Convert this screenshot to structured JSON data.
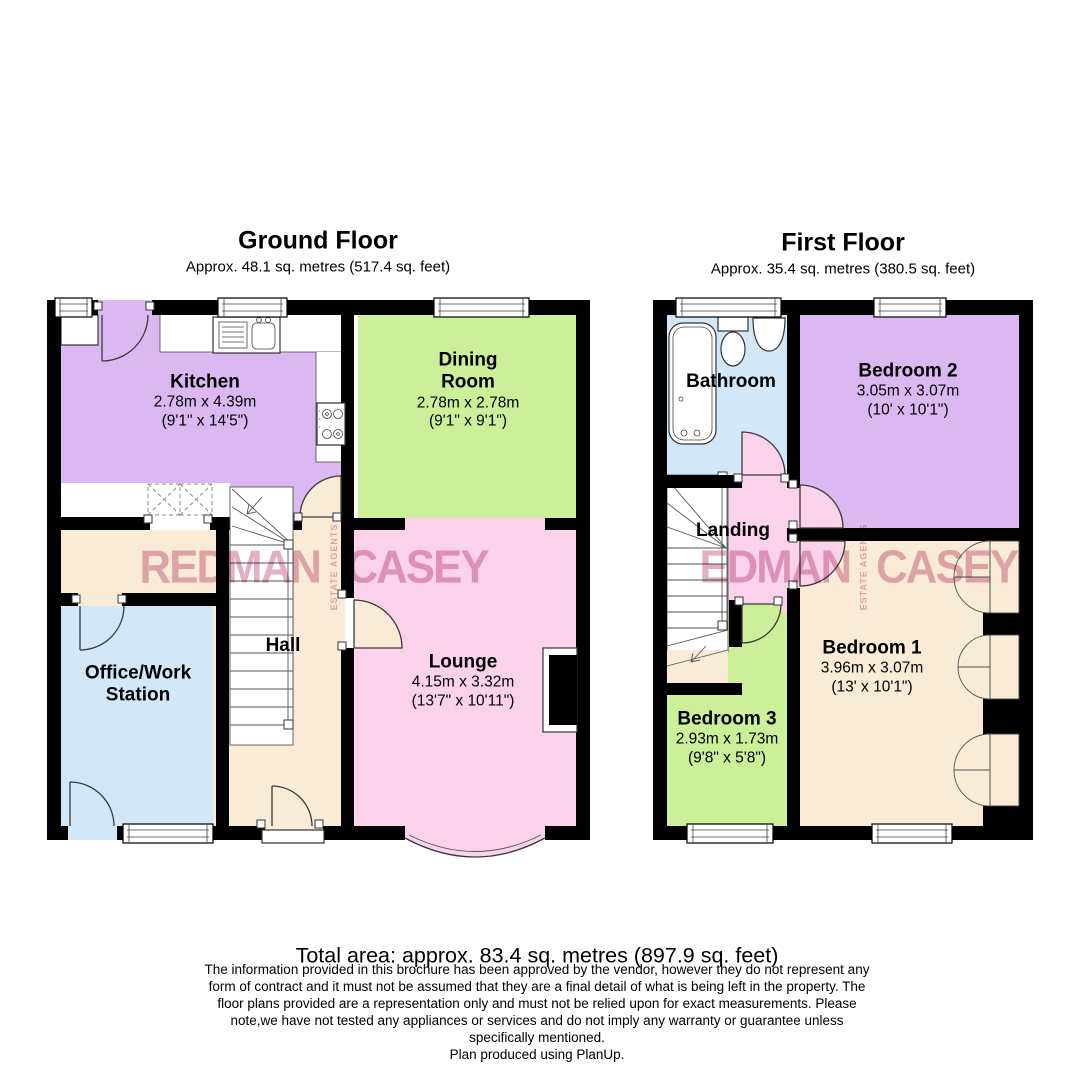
{
  "ground_floor": {
    "title": "Ground Floor",
    "subtitle": "Approx. 48.1 sq. metres (517.4 sq. feet)",
    "rooms": {
      "kitchen": {
        "name": "Kitchen",
        "metric": "2.78m x 4.39m",
        "imperial": "(9'1\" x 14'5\")"
      },
      "dining": {
        "name": "Dining Room",
        "metric": "2.78m x 2.78m",
        "imperial": "(9'1\" x 9'1\")"
      },
      "lounge": {
        "name": "Lounge",
        "metric": "4.15m x 3.32m",
        "imperial": "(13'7\" x 10'11\")"
      },
      "hall": {
        "name": "Hall"
      },
      "office": {
        "name": "Office/Work Station"
      }
    }
  },
  "first_floor": {
    "title": "First Floor",
    "subtitle": "Approx. 35.4 sq. metres (380.5 sq. feet)",
    "rooms": {
      "bathroom": {
        "name": "Bathroom"
      },
      "bedroom2": {
        "name": "Bedroom 2",
        "metric": "3.05m x 3.07m",
        "imperial": "(10' x 10'1\")"
      },
      "landing": {
        "name": "Landing"
      },
      "bedroom1": {
        "name": "Bedroom 1",
        "metric": "3.96m x 3.07m",
        "imperial": "(13' x 10'1\")"
      },
      "bedroom3": {
        "name": "Bedroom 3",
        "metric": "2.93m x 1.73m",
        "imperial": "(9'8\" x 5'8\")"
      }
    }
  },
  "watermark": {
    "ground_text": "REDMAN",
    "first_text": "EDMAN",
    "right_text": "CASEY",
    "vertical_text": "ESTATE AGENTS"
  },
  "footer": {
    "total_area": "Total area: approx. 83.4 sq. metres (897.9 sq. feet)",
    "disclaimer_lines": [
      "The information provided in this brochure has been approved by the vendor, however they do not represent any",
      "form of contract and it must not be assumed that they are a final detail of what is being left in the property. The",
      "floor plans provided are a representation only and must not be relied upon for exact measurements. Please",
      "note,we have not tested any appliances or services and do not imply any warranty or guarantee unless",
      "specifically mentioned."
    ],
    "produced": "Plan produced using PlanUp."
  },
  "colors": {
    "room_purple": "#DCB8F2",
    "room_green": "#CCEF9A",
    "room_pink": "#FAD2EA",
    "room_beige": "#FAEBD7",
    "room_blue": "#D2E7F8",
    "wall": "#000000",
    "watermark_pink": "#CF7FA2"
  }
}
